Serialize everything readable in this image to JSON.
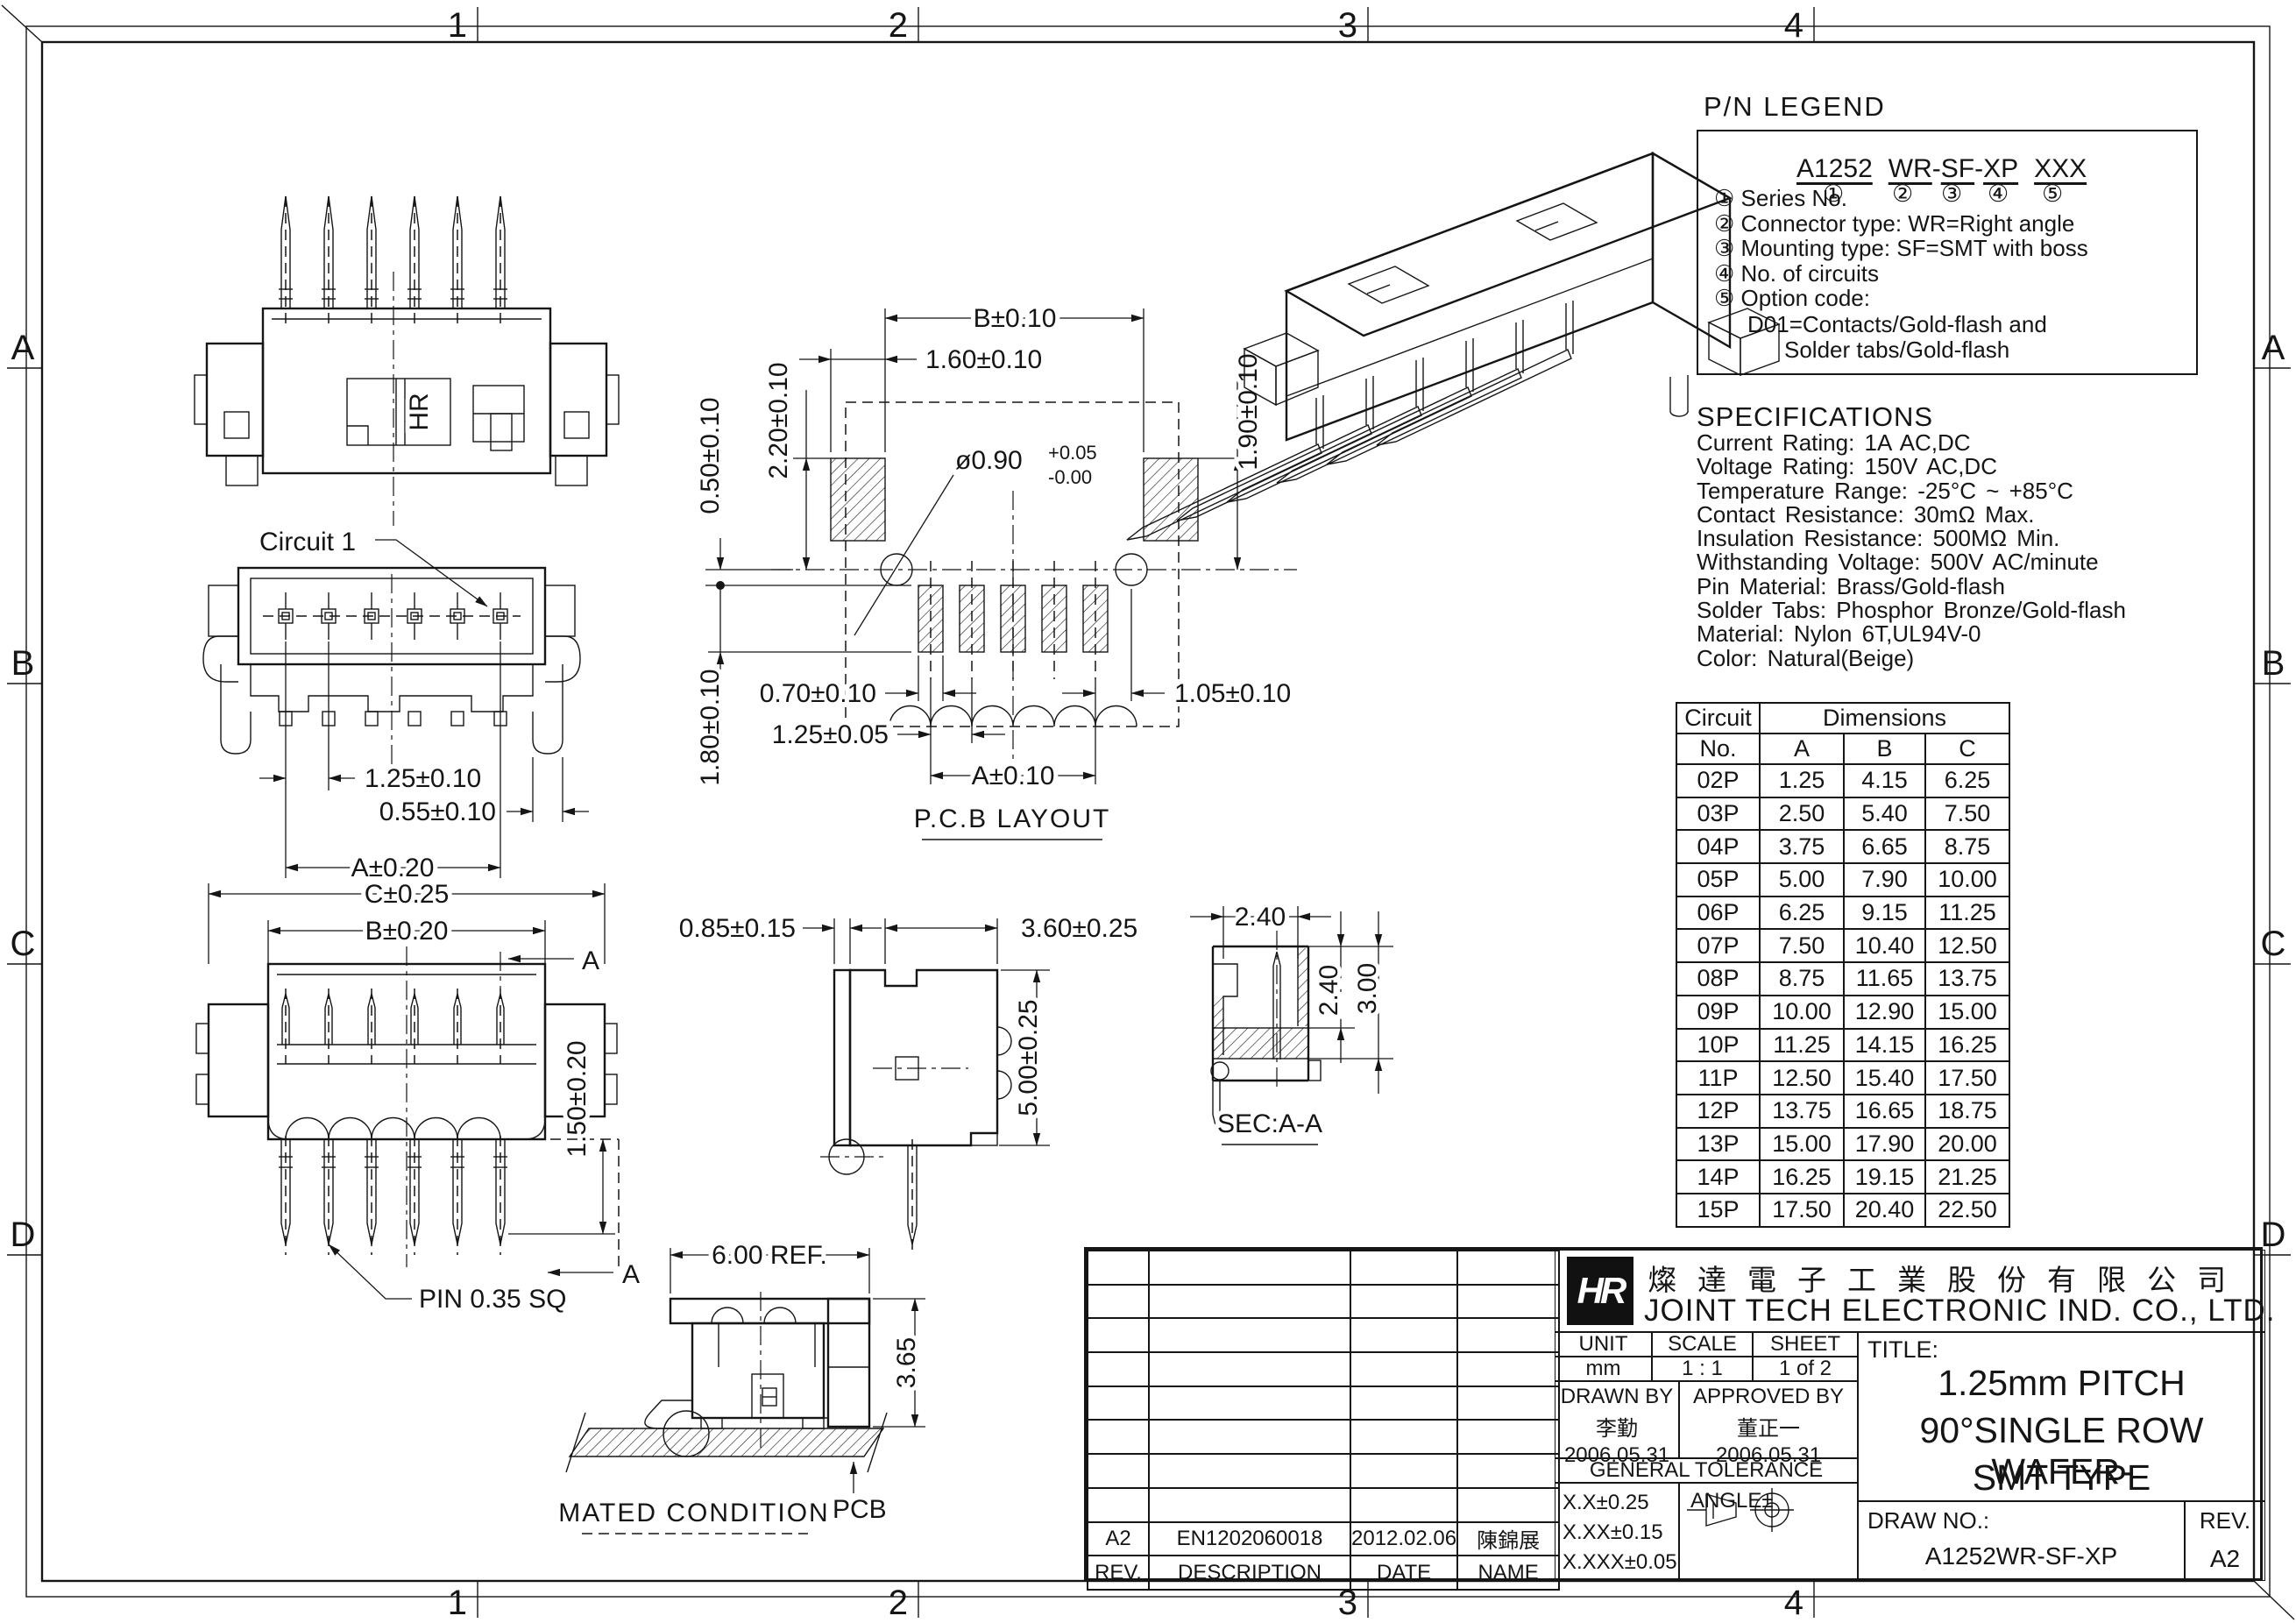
{
  "border": {
    "top": [
      "1",
      "2",
      "3",
      "4"
    ],
    "bottom": [
      "1",
      "2",
      "3",
      "4"
    ],
    "left": [
      "A",
      "B",
      "C",
      "D"
    ],
    "right": [
      "A",
      "B",
      "C",
      "D"
    ]
  },
  "pn_legend": {
    "title": "P/N LEGEND",
    "part": [
      "A1252",
      "WR",
      "SF",
      "XP",
      "XXX"
    ],
    "dash": "-",
    "circles": [
      "①",
      "②",
      "③",
      "④",
      "⑤"
    ],
    "items": [
      "① Series No.",
      "② Connector type: WR=Right angle",
      "③ Mounting type: SF=SMT with boss",
      "④ No. of circuits",
      "⑤ Option code:"
    ],
    "option1": "D01=Contacts/Gold-flash and",
    "option2": "Solder tabs/Gold-flash"
  },
  "specs": {
    "title": "SPECIFICATIONS",
    "lines": [
      "Current Rating: 1A AC,DC",
      "Voltage Rating: 150V AC,DC",
      "Temperature Range: -25°C ~ +85°C",
      "Contact Resistance: 30mΩ Max.",
      "Insulation Resistance: 500MΩ Min.",
      "Withstanding Voltage: 500V AC/minute",
      "Pin Material: Brass/Gold-flash",
      "Solder Tabs: Phosphor Bronze/Gold-flash",
      "Material: Nylon 6T,UL94V-0",
      "Color: Natural(Beige)"
    ]
  },
  "dim_table": {
    "col1_l1": "Circuit",
    "col1_l2": "No.",
    "group": "Dimensions",
    "cols": [
      "A",
      "B",
      "C"
    ],
    "rows": [
      [
        "02P",
        "1.25",
        "4.15",
        "6.25"
      ],
      [
        "03P",
        "2.50",
        "5.40",
        "7.50"
      ],
      [
        "04P",
        "3.75",
        "6.65",
        "8.75"
      ],
      [
        "05P",
        "5.00",
        "7.90",
        "10.00"
      ],
      [
        "06P",
        "6.25",
        "9.15",
        "11.25"
      ],
      [
        "07P",
        "7.50",
        "10.40",
        "12.50"
      ],
      [
        "08P",
        "8.75",
        "11.65",
        "13.75"
      ],
      [
        "09P",
        "10.00",
        "12.90",
        "15.00"
      ],
      [
        "10P",
        "11.25",
        "14.15",
        "16.25"
      ],
      [
        "11P",
        "12.50",
        "15.40",
        "17.50"
      ],
      [
        "12P",
        "13.75",
        "16.65",
        "18.75"
      ],
      [
        "13P",
        "15.00",
        "17.90",
        "20.00"
      ],
      [
        "14P",
        "16.25",
        "19.15",
        "21.25"
      ],
      [
        "15P",
        "17.50",
        "20.40",
        "22.50"
      ]
    ]
  },
  "views": {
    "top": {
      "marking": "HR"
    },
    "front": {
      "circuit": "Circuit 1",
      "pitch": "1.25±0.10",
      "pin_w": "0.55±0.10",
      "dim_a": "A±0.20"
    },
    "bottom": {
      "dim_c": "C±0.25",
      "dim_b": "B±0.20",
      "height": "1.50±0.20",
      "pin_callout": "PIN 0.35 SQ",
      "sec_a1": "A",
      "sec_a2": "A"
    },
    "pcb": {
      "title": "P.C.B LAYOUT",
      "dim_b": "B±0.10",
      "pad_w": "1.60±0.10",
      "pad_h": "2.20±0.10",
      "edge": "0.50±0.10",
      "hole": "ø0.90",
      "hole_p": "+0.05",
      "hole_m": "-0.00",
      "right_h": "1.90±0.10",
      "pad2_w": "0.70±0.10",
      "pitch": "1.25±0.05",
      "dim_a": "A±0.10",
      "last": "1.05±0.10",
      "depth": "1.80±0.10"
    },
    "side": {
      "standoff": "0.85±0.15",
      "depth": "3.60±0.25",
      "height": "5.00±0.25"
    },
    "sec": {
      "title": "SEC:A-A",
      "w": "2.40",
      "h1": "2.40",
      "h2": "3.00"
    },
    "mated": {
      "title": "MATED CONDITION",
      "width": "6.00 REF.",
      "height": "3.65",
      "pcb": "PCB"
    }
  },
  "title_block": {
    "company_cn": "燦達電子工業股份有限公司",
    "company_en": "JOINT TECH ELECTRONIC IND. CO., LTD.",
    "logo": "HR",
    "unit_label": "UNIT",
    "unit": "mm",
    "scale_label": "SCALE",
    "scale": "1 : 1",
    "sheet_label": "SHEET",
    "sheet": "1 of 2",
    "drawn_label": "DRAWN BY",
    "drawn_name": "李勤",
    "drawn_date": "2006.05.31",
    "approved_label": "APPROVED BY",
    "approved_name": "董正一",
    "approved_date": "2006.05.31",
    "tol_title": "GENERAL TOLERANCE",
    "tol1": "X.X±0.25",
    "tol2": "X.XX±0.15",
    "tol3": "X.XXX±0.05",
    "angle_label": "ANGLE±",
    "title_label": "TITLE:",
    "title_line1": "1.25mm PITCH",
    "title_line2": "90°SINGLE ROW WAFER-",
    "title_line3": "SMT TYPE",
    "draw_no_label": "DRAW NO.:",
    "draw_no": "A1252WR-SF-XP",
    "rev_label": "REV.",
    "rev": "A2",
    "revision": {
      "header": [
        "REV.",
        "DESCRIPTION",
        "DATE",
        "NAME"
      ],
      "entry": [
        "A2",
        "EN1202060018",
        "2012.02.06",
        "陳錦展"
      ]
    }
  }
}
